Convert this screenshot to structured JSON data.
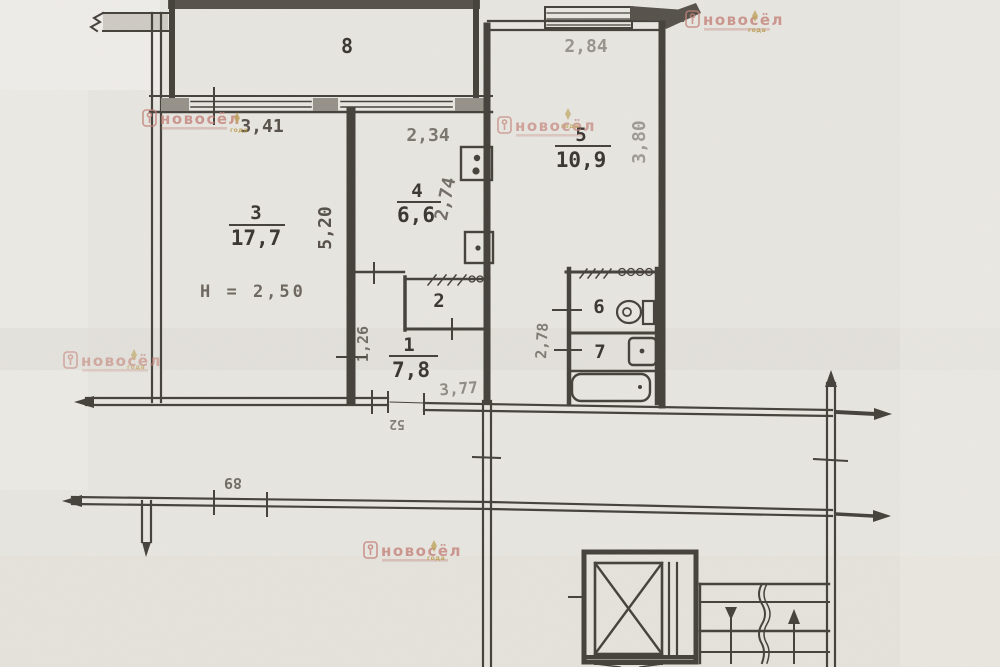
{
  "colors": {
    "paper": "#e8e6e1",
    "ink": "#46423c",
    "label_text": "#3b3733",
    "dim_text": "#57524b",
    "watermark": "#c4837a",
    "gold": "#b5953f"
  },
  "plan": {
    "rooms": {
      "r1": {
        "num": "1",
        "area": "7,8"
      },
      "r2": {
        "num": "2"
      },
      "r3": {
        "num": "3",
        "area": "17,7"
      },
      "r4": {
        "num": "4",
        "area": "6,6"
      },
      "r5": {
        "num": "5",
        "area": "10,9"
      },
      "r6": {
        "num": "6"
      },
      "r7": {
        "num": "7"
      },
      "r8": {
        "num": "8"
      }
    },
    "ceiling_height": "H = 2,50",
    "dims": {
      "room3_width": "3,41",
      "kitchen_width": "2,34",
      "room5_width": "2,84",
      "room5_depth": "3,80",
      "room3_depth": "5,20",
      "kitchen_depth": "2,74",
      "hall_depth": "1,26",
      "bath_depth": "2,78",
      "hall_width": "3,77",
      "door_width": "52",
      "corridor_mark": "89"
    }
  },
  "watermark": {
    "text": "новосёл",
    "emblem_caption": "года"
  }
}
